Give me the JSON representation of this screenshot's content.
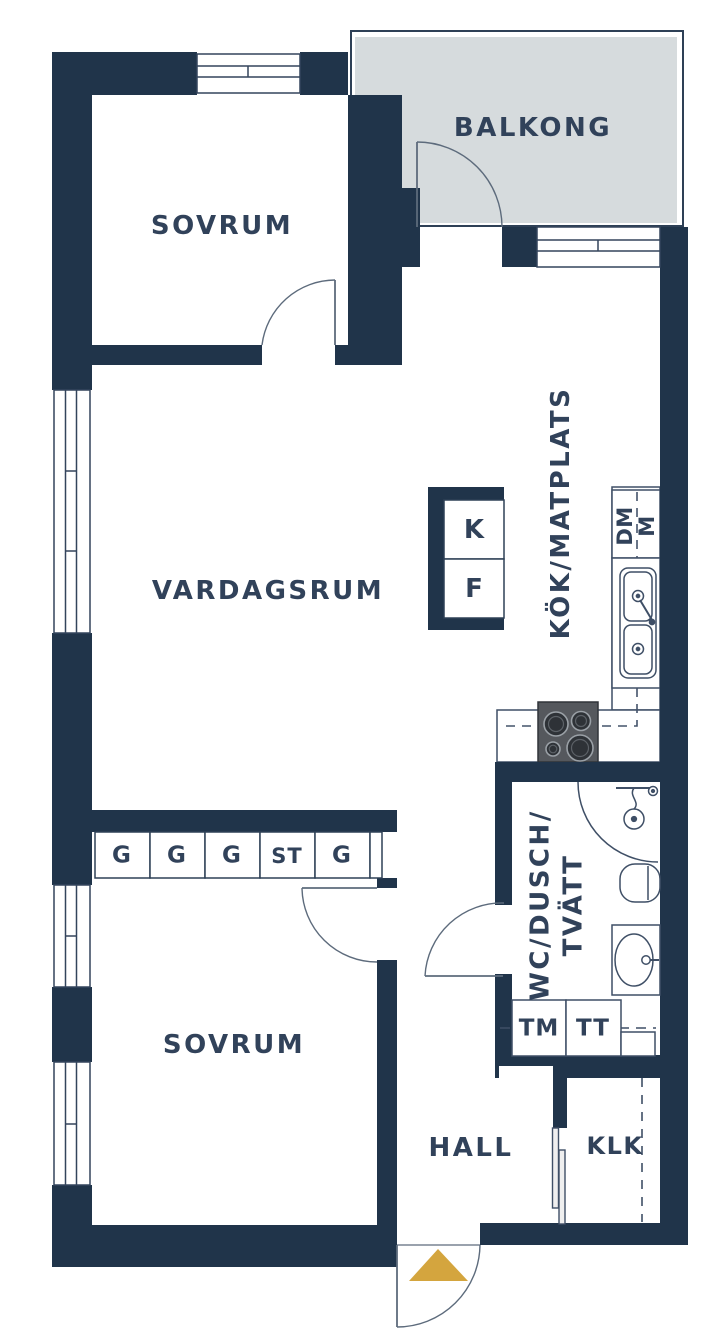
{
  "plan_title": "apartment-floor-plan",
  "palette": {
    "wall": "#20344a",
    "label_text": "#31425a",
    "balcony_fill": "#d6dbdd",
    "entrance_arrow": "#d4a53e",
    "stove_body": "#55585d",
    "thin_line": "#3f4f66"
  },
  "rooms": {
    "balcony": "BALKONG",
    "bedroom_top": "SOVRUM",
    "living_room": "VARDAGSRUM",
    "kitchen": "KÖK/MATPLATS",
    "bathroom_line1": "WC/DUSCH/",
    "bathroom_line2": "TVÄTT",
    "bedroom_bottom": "SOVRUM",
    "hall": "HALL",
    "closet": "KLK"
  },
  "appliances": {
    "fridge": "K",
    "freezer": "F",
    "dishwasher": "DM",
    "microwave": "M",
    "washing_machine": "TM",
    "tumble_dryer": "TT"
  },
  "wardrobes": {
    "cells": [
      "G",
      "G",
      "G",
      "ST",
      "G"
    ]
  },
  "symbols": {
    "entrance_arrow": "entrance-direction-triangle",
    "doors": "quarter-circle-swing-arcs",
    "windows": "double-line-window-symbols"
  }
}
